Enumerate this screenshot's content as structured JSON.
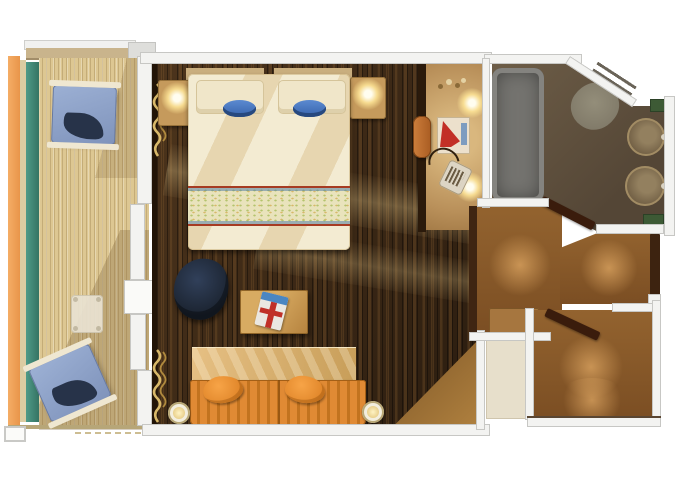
{
  "app": {
    "type": "floor-plan",
    "title": "Cruise ship balcony stateroom floor plan"
  },
  "palette": {
    "background": "#ffffff",
    "wall": "#f3f3f1",
    "wall_edge": "#c7c7c4",
    "balcony_deck": "#ddc792",
    "balcony_rail_orange": "#ef9f56",
    "balcony_divider_teal": "#418b79",
    "cabin_floor_dark": "#3e2b19",
    "hall_floor_brown": "#8f5f2f",
    "bathroom_floor_olive": "#675741",
    "bed_linen_cream": "#f3ebd2",
    "bed_band_red": "#a63b22",
    "accent_blue": "#3f70bd",
    "sofa_orange": "#e08a34",
    "cushion_orange": "#f7a447",
    "lounge_chair_blue": "#93a7cc",
    "armchair_navy": "#1a222e",
    "wood_tan": "#c59a5c",
    "lamp_glow": "#ffe698",
    "bathtub_gray": "#74736f",
    "towel_green": "#3d5a35",
    "door_dark_brown": "#3a1c0c"
  },
  "rooms": {
    "balcony": {
      "label": "Private balcony",
      "furniture": {
        "lounge_chairs": 2,
        "side_table": 1
      }
    },
    "bedroom": {
      "label": "Stateroom bedroom and sitting area",
      "furniture": {
        "king_bed": 1,
        "pillows": 2,
        "blue_bowls": 2,
        "nightstands_with_lamps": 2,
        "armchair": 1,
        "desk_with_magazine": 1,
        "sofa": 1,
        "sofa_cushions": 2,
        "wall_sconces": 2
      }
    },
    "vanity": {
      "label": "Vanity / dressing area",
      "furniture": {
        "lit_mirror_lamps": 2,
        "tissue_box": 1,
        "hair_dryer": 1,
        "stool": 1
      }
    },
    "bathroom": {
      "label": "Bathroom",
      "furniture": {
        "bathtub": 1,
        "toilet": 1,
        "round_sinks": 2,
        "green_towels": 2
      }
    },
    "entry": {
      "label": "Entry hallway and wardrobe",
      "furniture": {
        "open_doors": 2,
        "bench": 1
      }
    }
  }
}
